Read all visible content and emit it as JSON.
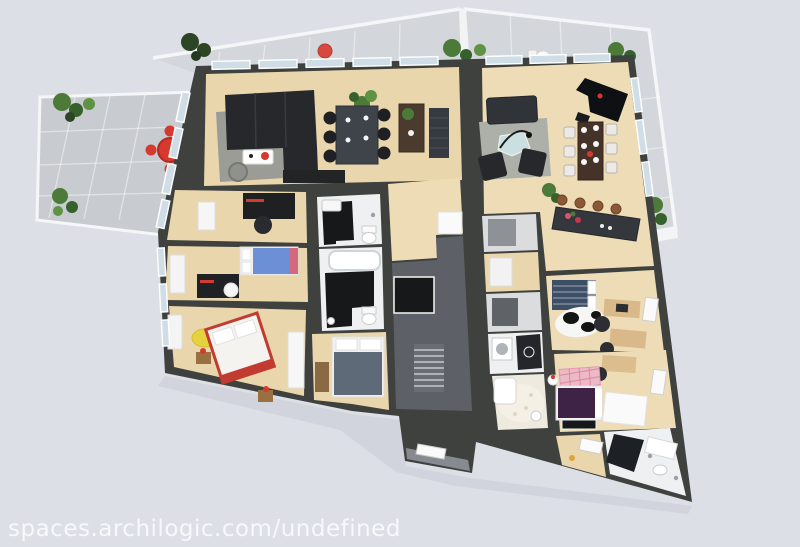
{
  "watermark": {
    "text": "spaces.archilogic.com/undefined"
  },
  "colors": {
    "background": "#dcdfe6",
    "wall": "#3e413d",
    "terrace_floor": "#c8ccd0",
    "balcony_floor": "#d3d7db",
    "wood_floor": "#e9d6ad",
    "wood_floor_light": "#eedcb6",
    "bathroom_white": "#eef0f2",
    "bathroom_tile": "#17181a",
    "stair_floor": "#5d6167",
    "entry_ramp": "#878b91",
    "rug_gray": "#9c9c96",
    "rug_light": "#adb0a9",
    "sofa_black": "#27282c",
    "furniture_dark": "#34383d",
    "wood_dark": "#45332a",
    "accent_red": "#d63a2f",
    "plant_green": "#4c7a38",
    "plant_dark": "#2c4525",
    "glass_pane": "#cfdde6",
    "bed_blue": "#6c8fd6",
    "bed_slate": "#5f6a78",
    "bed_purple": "#3f2347",
    "rug_pink": "#ecb9c6",
    "rug_yellow": "#e6d23e",
    "white": "#ffffff"
  }
}
